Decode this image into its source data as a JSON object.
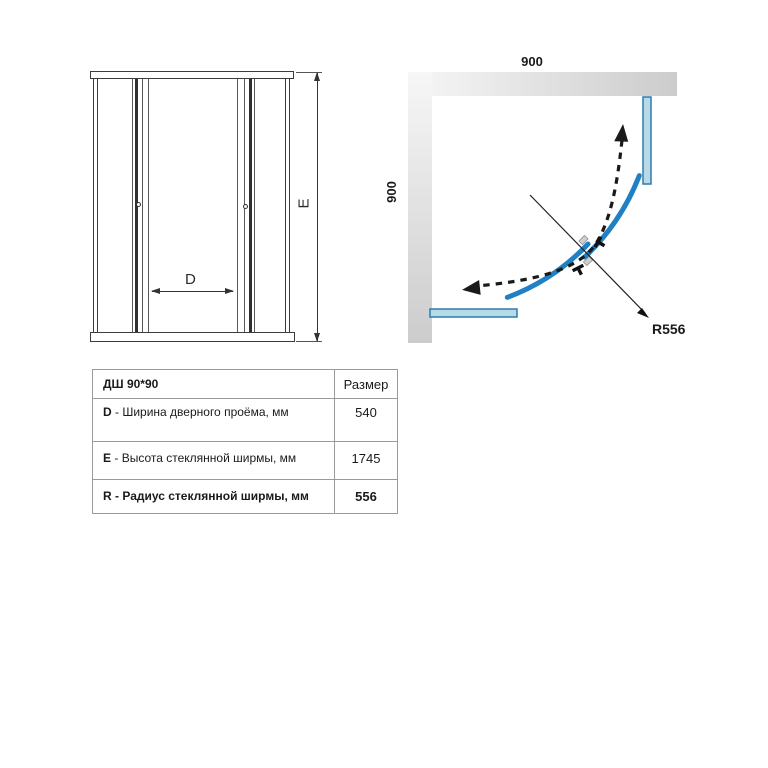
{
  "plan": {
    "dim_top": "900",
    "dim_left": "900",
    "radius_label": "R556"
  },
  "elevation": {
    "door_width_label": "D",
    "height_label": "E"
  },
  "table": {
    "header": {
      "model": "ДШ 90*90",
      "size": "Размер"
    },
    "rows": [
      {
        "letter": "D",
        "sep": " - ",
        "desc": "Ширина дверного проёма, мм",
        "value": "540"
      },
      {
        "letter": "E",
        "sep": " - ",
        "desc": "Высота стеклянной ширмы, мм",
        "value": "1745"
      },
      {
        "letter": "R",
        "sep": " - ",
        "desc": "Радиус стеклянной ширмы, мм",
        "value": "556"
      }
    ]
  },
  "colors": {
    "door_arc_blue": "#1f80c3",
    "glass_panel_fill": "#b8d9e8",
    "glass_panel_stroke": "#2d7cad",
    "wall_gray": "#d0d0d0"
  }
}
